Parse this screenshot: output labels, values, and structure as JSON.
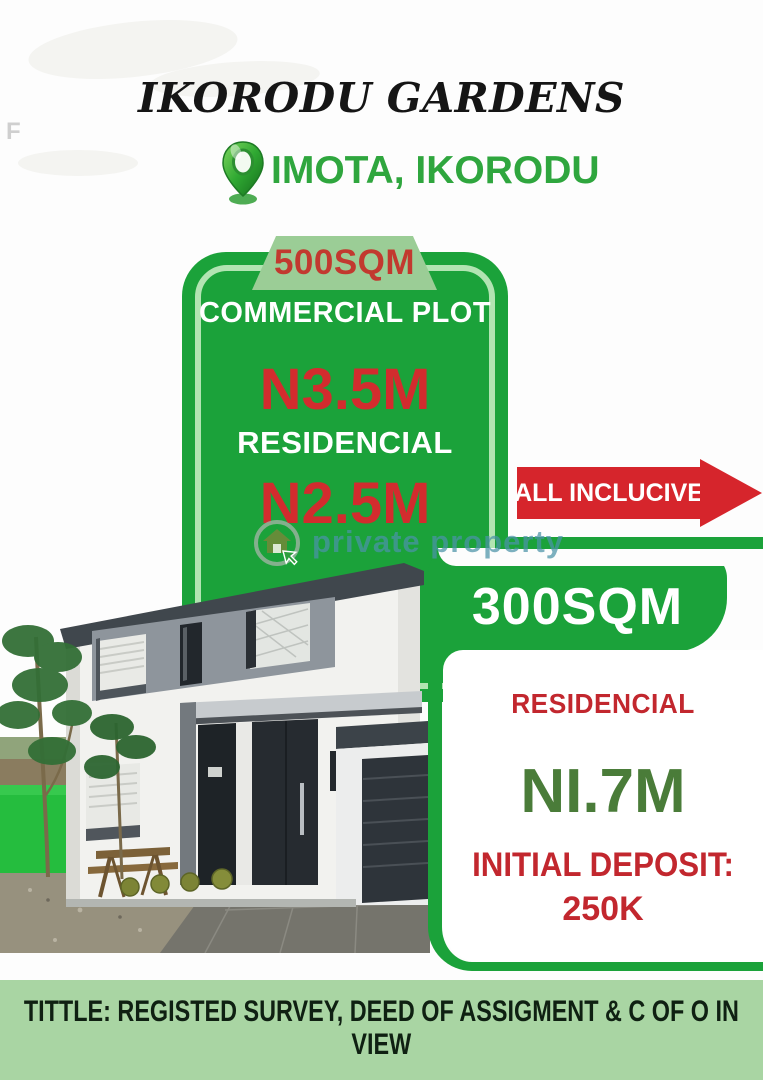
{
  "flyer": {
    "stray_letter": "F",
    "title": "IKORODU GARDENS",
    "location": "IMOTA, IKORODU",
    "offer_500": {
      "size_tab": "500SQM",
      "plot_type": "COMMERCIAL PLOT",
      "price_commercial": "N3.5M",
      "residential_label": "RESIDENCIAL",
      "price_residential": "N2.5M"
    },
    "inclusive_banner": "ALL INCLUCIVE",
    "watermark_brand": "private property",
    "offer_300": {
      "size_banner": "300SQM",
      "type_label": "RESIDENCIAL",
      "price": "NI.7M",
      "deposit_label": "INITIAL DEPOSIT:",
      "deposit_amount": "250K"
    },
    "footer": {
      "line1": "TITTLE: REGISTED SURVEY, DEED OF ASSIGMENT & C OF O IN",
      "line2": "VIEW"
    },
    "colors": {
      "brand_green": "#1ba23a",
      "footer_strip_green": "#a9d5a3",
      "price_red": "#d22c2e",
      "banner_red": "#d6252c",
      "deep_green_price": "#4a7c39",
      "location_green": "#2fa63e",
      "watermark_teal": "#4b93a8",
      "tab_light_green": "#9bcd96"
    }
  }
}
